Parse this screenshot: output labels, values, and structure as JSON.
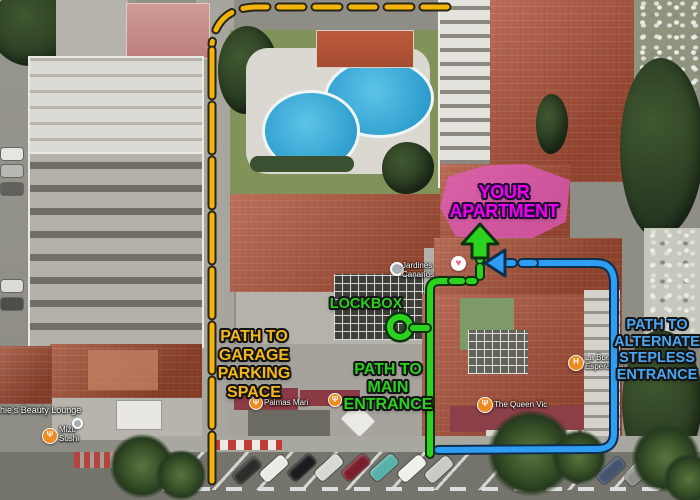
{
  "annotations": {
    "apartment": {
      "lines": [
        "YOUR",
        "APARTMENT"
      ],
      "color": "#ee00ee",
      "highlight_color": "#e95bcd"
    },
    "lockbox": {
      "text": "LOCKBOX",
      "color": "#2bd01f"
    },
    "garage_path": {
      "lines": [
        "PATH TO",
        "GARAGE",
        "PARKING",
        "SPACE"
      ],
      "color": "#f5b819"
    },
    "main_path": {
      "lines": [
        "PATH TO",
        "MAIN",
        "ENTRANCE"
      ],
      "color": "#2bd01f"
    },
    "alternate_path": {
      "lines": [
        "PATH TO",
        "ALTERNATE",
        "STEPLESS",
        "ENTRANCE"
      ],
      "color": "#4ba6f2"
    },
    "path_colors": {
      "garage": "#f2b30b",
      "main": "#2cd21f",
      "alternate": "#2f9df2"
    }
  },
  "pois": [
    {
      "name": "Jardines Canarios",
      "icon": "location-dot"
    },
    {
      "name": "La Buena Esperanza",
      "icon": "hotel"
    },
    {
      "name": "The Queen Vic",
      "icon": "restaurant"
    },
    {
      "name": "Mizu Sushi",
      "icon": "restaurant"
    },
    {
      "name": "Palmas Mari",
      "icon": "restaurant"
    },
    {
      "name": "Sophie's Beauty Lounge",
      "icon": "store"
    }
  ],
  "icons": {
    "hotel": "H",
    "restaurant": "Ψ",
    "heart": "♥"
  }
}
